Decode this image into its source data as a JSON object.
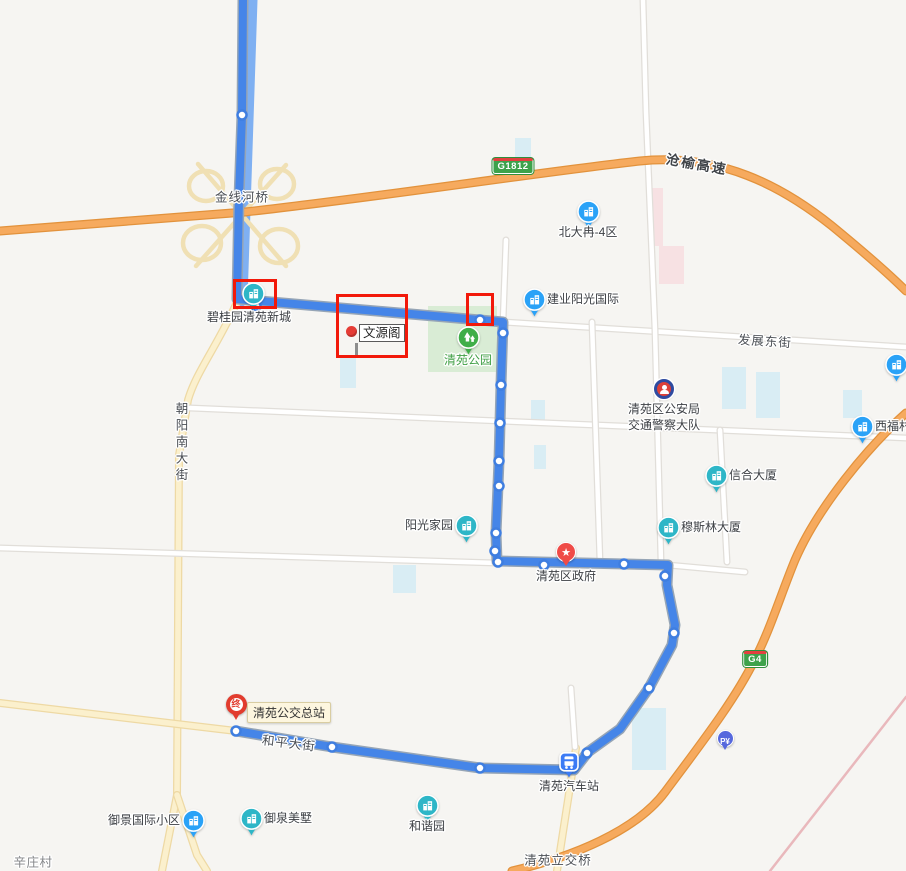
{
  "icons": {
    "star": "★"
  },
  "shields": {
    "g1812": "G1812",
    "g4": "G4"
  },
  "street_labels": {
    "jinxianheqiao": "金线河桥",
    "cangyu_expressway": "沧榆高速",
    "fazhan_east_street": "发展东街",
    "chaoyang_south_street": "朝阳南大街",
    "heping_street": "和平大街",
    "qingyuan_interchange": "清苑立交桥",
    "xinzhuang_village": "辛庄村"
  },
  "pois": {
    "beidaran": "北大冉-4区",
    "jianye": "建业阳光国际",
    "biguiyuan": "碧桂园清苑新城",
    "wenyuange": "文源阁",
    "qingyuan_park": "清苑公园",
    "police_line1": "清苑区公安局",
    "police_line2": "交通警察大队",
    "xifucun": "西福村",
    "xinhe": "信合大厦",
    "musilin": "穆斯林大厦",
    "yangguang": "阳光家园",
    "gov": "清苑区政府",
    "terminal_badge": "终",
    "bus_terminal": "清苑公交总站",
    "bus_station": "清苑汽车站",
    "parking": "P¥",
    "yujing": "御景国际小区",
    "yuquan": "御泉美墅",
    "hexie": "和谐园"
  },
  "map": {
    "width": 906,
    "height": 871,
    "colors": {
      "background": "#f6f5f2",
      "route": "#4585e8",
      "route_casing": "#96a5b6",
      "stop_fill": "#ffffff",
      "stop_stroke": "#3f7ee0",
      "highlight": "#f2190a",
      "expressway": "#f6aa5e",
      "expressway_casing": "#e2923c",
      "minor_road": "#fbf0cd",
      "minor_road_casing": "#eed9a4",
      "white_road": "#ffffff",
      "white_road_casing": "#e1ded9",
      "ramp": "#f0e0b4",
      "river": "#7fb0f2",
      "railway": "#e9b8bc",
      "park": "#d9ecd5",
      "water_patch": "#d9edf4",
      "hospital_patch": "#f7e1e3",
      "poi_teal": "#2eb6c7",
      "poi_blue": "#2aa2f7",
      "park_green": "#3fae48"
    },
    "roads": [
      {
        "name": "jinxian-river",
        "type": "river",
        "d": "M251,0 L246,150 L241,300"
      },
      {
        "name": "ramp-loop-nw",
        "type": "ramp",
        "d": "M189,186 a17,15 0 1 0 34,0 a17,15 0 1 0 -34,0"
      },
      {
        "name": "ramp-loop-ne",
        "type": "ramp",
        "d": "M260,184 a17,15 0 1 0 34,0 a17,15 0 1 0 -34,0"
      },
      {
        "name": "ramp-loop-sw",
        "type": "ramp",
        "d": "M183,243 a19,17 0 1 0 38,0 a19,17 0 1 0 -38,0"
      },
      {
        "name": "ramp-loop-se",
        "type": "ramp",
        "d": "M260,246 a19,17 0 1 0 38,0 a19,17 0 1 0 -38,0"
      },
      {
        "name": "ramp-diagonal-1",
        "type": "ramp",
        "d": "M198,164 L286,266"
      },
      {
        "name": "ramp-diagonal-2",
        "type": "ramp",
        "d": "M286,165 L196,266"
      },
      {
        "name": "chaoyang-south-street",
        "type": "yellow",
        "d": "M238,300 C218,345 196,372 188,400 L179,455 L177,795"
      },
      {
        "name": "chaoyang-branch-west",
        "type": "yellow",
        "d": "M177,795 L162,871"
      },
      {
        "name": "chaoyang-branch-east",
        "type": "yellow",
        "d": "M177,795 L197,855 L207,871"
      },
      {
        "name": "heping-street-west",
        "type": "yellow",
        "d": "M0,703 L236,731"
      },
      {
        "name": "south-road",
        "type": "yellow",
        "d": "M576,748 L557,871"
      },
      {
        "name": "fazhan-east-street",
        "type": "white",
        "d": "M237,301 L503,322 L906,347"
      },
      {
        "name": "middle-road",
        "type": "white",
        "d": "M190,408 L906,438"
      },
      {
        "name": "gov-street-west",
        "type": "white",
        "d": "M0,548 L497,563"
      },
      {
        "name": "gov-street-east",
        "type": "white",
        "d": "M668,565 L745,572"
      },
      {
        "name": "road-v500",
        "type": "white",
        "d": "M506,240 L503,322 L495,563"
      },
      {
        "name": "road-v595",
        "type": "white",
        "d": "M592,322 L600,562"
      },
      {
        "name": "road-v650",
        "type": "white",
        "d": "M643,0 L646,112 L655,330 L661,562"
      },
      {
        "name": "road-v727",
        "type": "white",
        "d": "M720,430 L727,562"
      },
      {
        "name": "bus-station-north-road",
        "type": "white",
        "d": "M571,688 L575,747"
      },
      {
        "name": "cangyu-expressway",
        "type": "orange",
        "d": "M0,231 C120,222 200,216 245,212 C380,197 540,172 640,161 C720,153 782,186 832,226 C860,249 886,271 906,291"
      },
      {
        "name": "g4-expressway",
        "type": "orange",
        "d": "M906,413 C868,447 818,507 795,560 C781,594 770,630 755,659 C735,700 700,745 665,792 C636,831 572,857 512,871"
      },
      {
        "name": "railway",
        "type": "railway",
        "d": "M906,697 L770,871"
      }
    ],
    "patches": [
      {
        "name": "qingyuan-park-area",
        "type": "park",
        "x": 428,
        "y": 306,
        "w": 69,
        "h": 66
      },
      {
        "name": "water-1",
        "type": "cyan",
        "x": 515,
        "y": 138,
        "w": 16,
        "h": 22
      },
      {
        "name": "water-2",
        "type": "cyan",
        "x": 340,
        "y": 358,
        "w": 16,
        "h": 30
      },
      {
        "name": "water-3",
        "type": "cyan",
        "x": 531,
        "y": 400,
        "w": 14,
        "h": 26
      },
      {
        "name": "water-4",
        "type": "cyan",
        "x": 534,
        "y": 445,
        "w": 12,
        "h": 24
      },
      {
        "name": "water-5",
        "type": "cyan",
        "x": 722,
        "y": 367,
        "w": 24,
        "h": 42
      },
      {
        "name": "water-6",
        "type": "cyan",
        "x": 756,
        "y": 372,
        "w": 24,
        "h": 46
      },
      {
        "name": "water-7",
        "type": "cyan",
        "x": 843,
        "y": 390,
        "w": 19,
        "h": 28
      },
      {
        "name": "water-8",
        "type": "cyan",
        "x": 393,
        "y": 565,
        "w": 23,
        "h": 28
      },
      {
        "name": "water-9",
        "type": "cyan",
        "x": 632,
        "y": 708,
        "w": 34,
        "h": 62
      },
      {
        "name": "hospital-1",
        "type": "pink",
        "x": 650,
        "y": 188,
        "w": 13,
        "h": 58
      },
      {
        "name": "hospital-2",
        "type": "pink",
        "x": 659,
        "y": 246,
        "w": 25,
        "h": 38
      }
    ],
    "route": {
      "d": "M243,0 L242,115 L239,198 L237,299 L503,322 L501,385 L499,461 L496,533 L497,561 L668,565 L667,585 L675,625 L672,645 L649,688 L620,729 L588,752 L574,770 L480,768 L332,747 L236,731",
      "stops": [
        [
          242,
          115
        ],
        [
          256,
          306
        ],
        [
          480,
          320
        ],
        [
          503,
          333
        ],
        [
          501,
          385
        ],
        [
          500,
          423
        ],
        [
          499,
          461
        ],
        [
          499,
          486
        ],
        [
          496,
          533
        ],
        [
          495,
          551
        ],
        [
          498,
          562
        ],
        [
          544,
          565
        ],
        [
          624,
          564
        ],
        [
          665,
          576
        ],
        [
          674,
          633
        ],
        [
          649,
          688
        ],
        [
          587,
          753
        ],
        [
          480,
          768
        ],
        [
          332,
          747
        ],
        [
          236,
          731
        ]
      ]
    },
    "highlights": [
      {
        "x": 233,
        "y": 279,
        "w": 44,
        "h": 30
      },
      {
        "x": 336,
        "y": 294,
        "w": 72,
        "h": 64
      },
      {
        "x": 466,
        "y": 293,
        "w": 28,
        "h": 33
      }
    ]
  }
}
